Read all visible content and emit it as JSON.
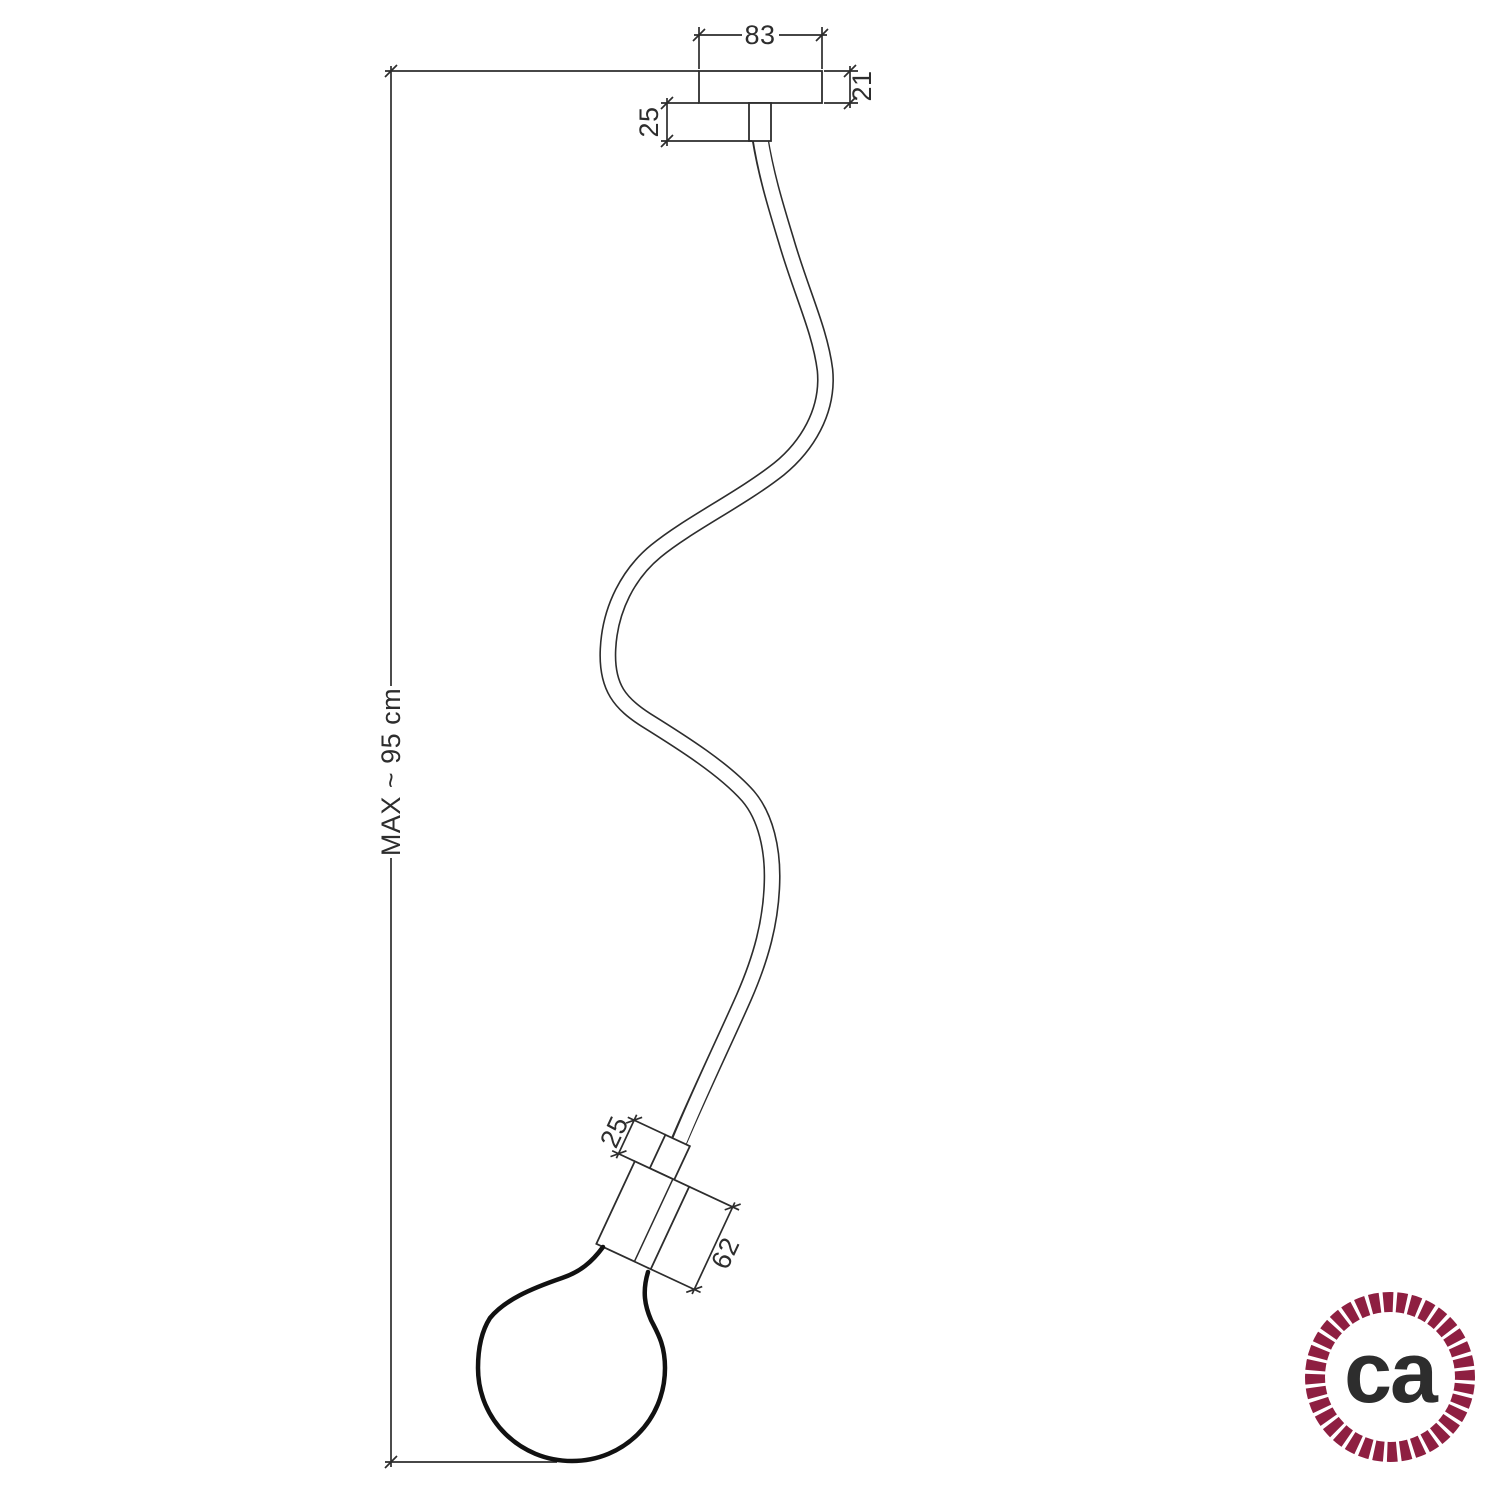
{
  "drawing": {
    "title": "pendant-lamp-dimension-drawing",
    "dims": {
      "rose_width": {
        "label": "83"
      },
      "rose_height": {
        "label": "21"
      },
      "top_stub_length": {
        "label": "25"
      },
      "overall_drop": {
        "label": "MAX ~ 95 cm"
      },
      "holder_stub_length": {
        "label": "25"
      },
      "holder_length": {
        "label": "62"
      }
    }
  },
  "logo": {
    "text": "ca",
    "ring_color": "#8e1f41",
    "text_color": "#5f6367"
  },
  "colors": {
    "line": "#2d2d2d",
    "bulb_line": "#111111",
    "background": "#ffffff"
  }
}
